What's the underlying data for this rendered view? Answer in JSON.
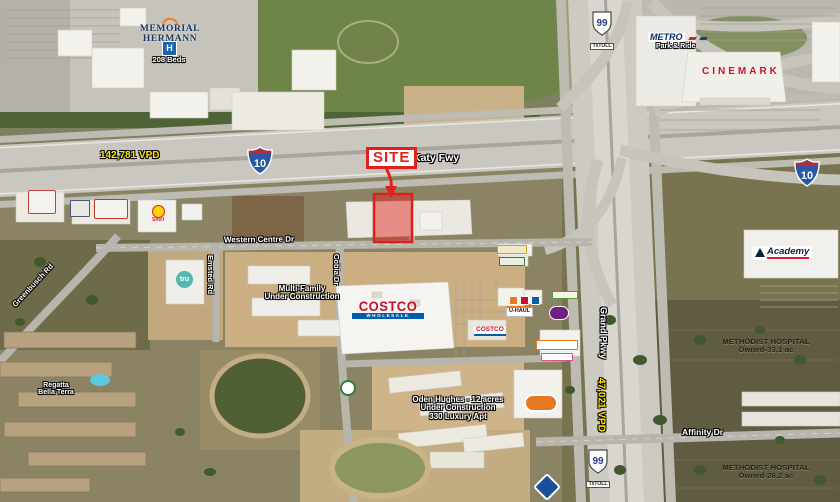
{
  "site": {
    "label": "SITE"
  },
  "highways": {
    "i10": {
      "shield": "10",
      "name": "Katy Fwy",
      "vpd": "142,781 VPD"
    },
    "tx99": {
      "shield": "99",
      "toll_tag": "TxTOLL",
      "name": "Grand Pkwy",
      "vpd": "47,021 VPD"
    }
  },
  "streets": {
    "western_centre": "Western Centre Dr",
    "emsted": "Emsted Rd",
    "greenbusch": "Greenbusch Rd",
    "cobia": "Cobia Dr",
    "affinity": "Affinity Dr"
  },
  "places": {
    "memorial_hermann": {
      "line1": "MEMORIAL",
      "line2": "HERMANN",
      "h_sign": "H",
      "beds": "208 Beds"
    },
    "metro": {
      "name": "METRO",
      "sub": "Park & Ride"
    },
    "cinemark": {
      "name": "CINEMARK"
    },
    "shell": {
      "name": "Shell"
    },
    "tru": {
      "name": "tru"
    },
    "costco": {
      "name": "COSTCO",
      "sub": "WHOLESALE"
    },
    "costco_gas": {
      "name": "COSTCO"
    },
    "uhaul": {
      "name": "U-HAUL"
    },
    "academy": {
      "name": "Academy"
    },
    "methodist_north": {
      "line1": "METHODIST HOSPITAL",
      "line2": "Owned-33.1 ac"
    },
    "methodist_south": {
      "line1": "METHODIST HOSPITAL",
      "line2": "Owned-26.2 ac"
    },
    "regatta": {
      "line1": "Regatta",
      "line2": "Bella Terra"
    }
  },
  "construction": {
    "multifamily": {
      "line1": "Multi-Family",
      "line2": "Under Construction"
    },
    "oden": {
      "line1": "Oden Hughes - 12 acres",
      "line2": "Under Construction",
      "line3": "330 Luxury Apt"
    }
  },
  "colors": {
    "site_red": "#e0201c",
    "vpd_yellow": "#ffe600",
    "interstate_blue": "#2a58a7",
    "interstate_red": "#c1272d",
    "tx99_blue": "#2b3990",
    "costco_red": "#c8102e",
    "costco_blue": "#005daa",
    "memorial_navy": "#1c3764",
    "memorial_orange": "#f58025",
    "metro_navy": "#0d2f6e",
    "cinemark_red": "#c8102e",
    "shell_yellow": "#ffd500",
    "shell_red": "#dd1d21",
    "tru_teal": "#52b8b1",
    "academy_navy": "#0b2341",
    "academy_red": "#e11931",
    "hospital_sign_blue": "#1b63b5",
    "uhaul_orange": "#f47920"
  },
  "logo_chips": [
    {
      "name": "red-white-strip-logo",
      "x": 28,
      "y": 190,
      "w": 28,
      "h": 24,
      "bg": "#f4f2ee",
      "bd": "1px solid #b84338",
      "br": 2
    },
    {
      "name": "dark-plaza-logo",
      "x": 70,
      "y": 200,
      "w": 20,
      "h": 17,
      "bg": "#e9e7e1",
      "bd": "1px solid #4a5a74",
      "br": 1
    },
    {
      "name": "red-script-logo",
      "x": 94,
      "y": 199,
      "w": 34,
      "h": 20,
      "bg": "#f4f2ee",
      "bd": "1px solid #c0392b",
      "br": 2
    },
    {
      "name": "yellow-strip-logo",
      "x": 497,
      "y": 245,
      "w": 30,
      "h": 9,
      "bg": "#f2e9c8",
      "bd": "1px solid #c9a227",
      "br": 1
    },
    {
      "name": "green-strip-logo",
      "x": 499,
      "y": 257,
      "w": 26,
      "h": 9,
      "bg": "#e9f0e2",
      "bd": "1px solid #3a7d2c",
      "br": 1
    },
    {
      "name": "orange-pad-logo",
      "x": 509,
      "y": 296,
      "w": 9,
      "h": 9,
      "bg": "#e87722",
      "bd": "1px solid #fff",
      "br": 1
    },
    {
      "name": "red-pad-logo",
      "x": 520,
      "y": 296,
      "w": 9,
      "h": 9,
      "bg": "#c8102e",
      "bd": "1px solid #fff",
      "br": 1
    },
    {
      "name": "blue-pad-logo",
      "x": 531,
      "y": 296,
      "w": 9,
      "h": 9,
      "bg": "#005daa",
      "bd": "1px solid #fff",
      "br": 1
    },
    {
      "name": "yellow-green-text-logo",
      "x": 552,
      "y": 291,
      "w": 26,
      "h": 8,
      "bg": "#f7f3df",
      "bd": "1px solid #4c9e45",
      "br": 1
    },
    {
      "name": "purple-oval-logo",
      "x": 549,
      "y": 306,
      "w": 20,
      "h": 14,
      "bg": "#702082",
      "bd": "1px solid #fff",
      "br": 7
    },
    {
      "name": "white-orange-text-logo",
      "x": 536,
      "y": 340,
      "w": 42,
      "h": 10,
      "bg": "#ffffff",
      "bd": "1px solid #e87722",
      "br": 1
    },
    {
      "name": "pink-text-logo",
      "x": 541,
      "y": 353,
      "w": 32,
      "h": 8,
      "bg": "#ffffff",
      "bd": "1px solid #d6568e",
      "br": 1
    },
    {
      "name": "orange-oval-logo",
      "x": 524,
      "y": 394,
      "w": 34,
      "h": 18,
      "bg": "#e87722",
      "bd": "2px solid #fff",
      "br": 9
    },
    {
      "name": "blue-diamond-logo",
      "x": 537,
      "y": 477,
      "w": 20,
      "h": 20,
      "bg": "#1b4e9b",
      "bd": "2px solid #fff",
      "br": 3,
      "rot": 45
    },
    {
      "name": "green-circle-logo",
      "x": 340,
      "y": 380,
      "w": 16,
      "h": 16,
      "bg": "#ffffff",
      "bd": "2px solid #2d7d46",
      "br": 8
    }
  ]
}
